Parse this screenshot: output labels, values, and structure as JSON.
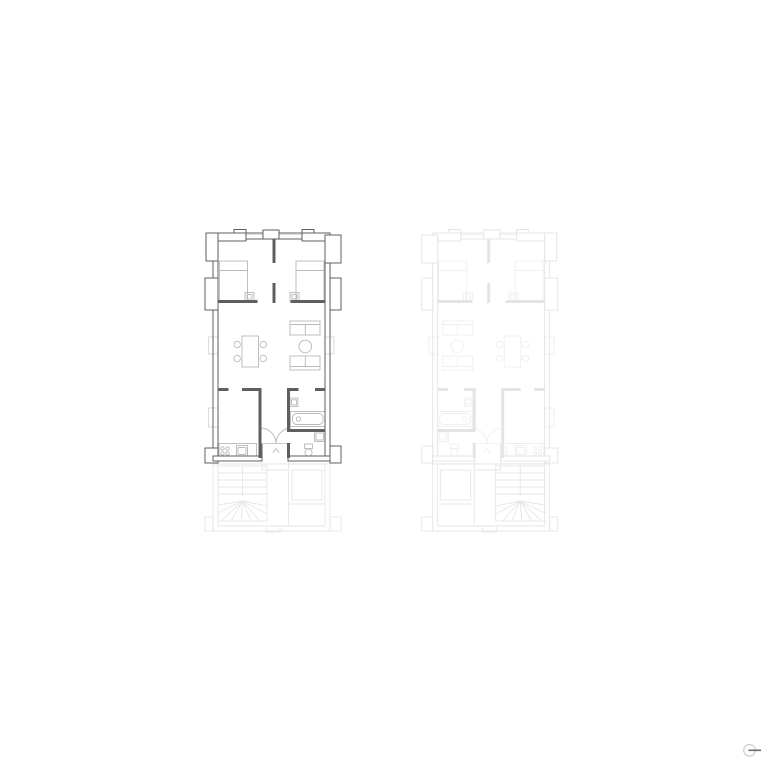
{
  "canvas": {
    "width": 767,
    "height": 767,
    "background": "#ffffff"
  },
  "drawing": {
    "type": "architectural-floor-plan",
    "active_unit_position": "left",
    "ghost_unit_position": "right-mirrored"
  },
  "palette": {
    "canvas_bg": "#ffffff",
    "wall_dark": "#5f5f5f",
    "furniture_gray": "#b9b9b9",
    "window_gray": "#d8d8d8",
    "ghost_wall": "#e4e4e4",
    "ghost_furniture": "#efefef",
    "ghost_lower": "#e6e6e6",
    "icon_ring": "#cfcfcf",
    "icon_needle": "#6f6f6f"
  },
  "compass_icon": {
    "shape": "circle-with-horizontal-needle"
  }
}
